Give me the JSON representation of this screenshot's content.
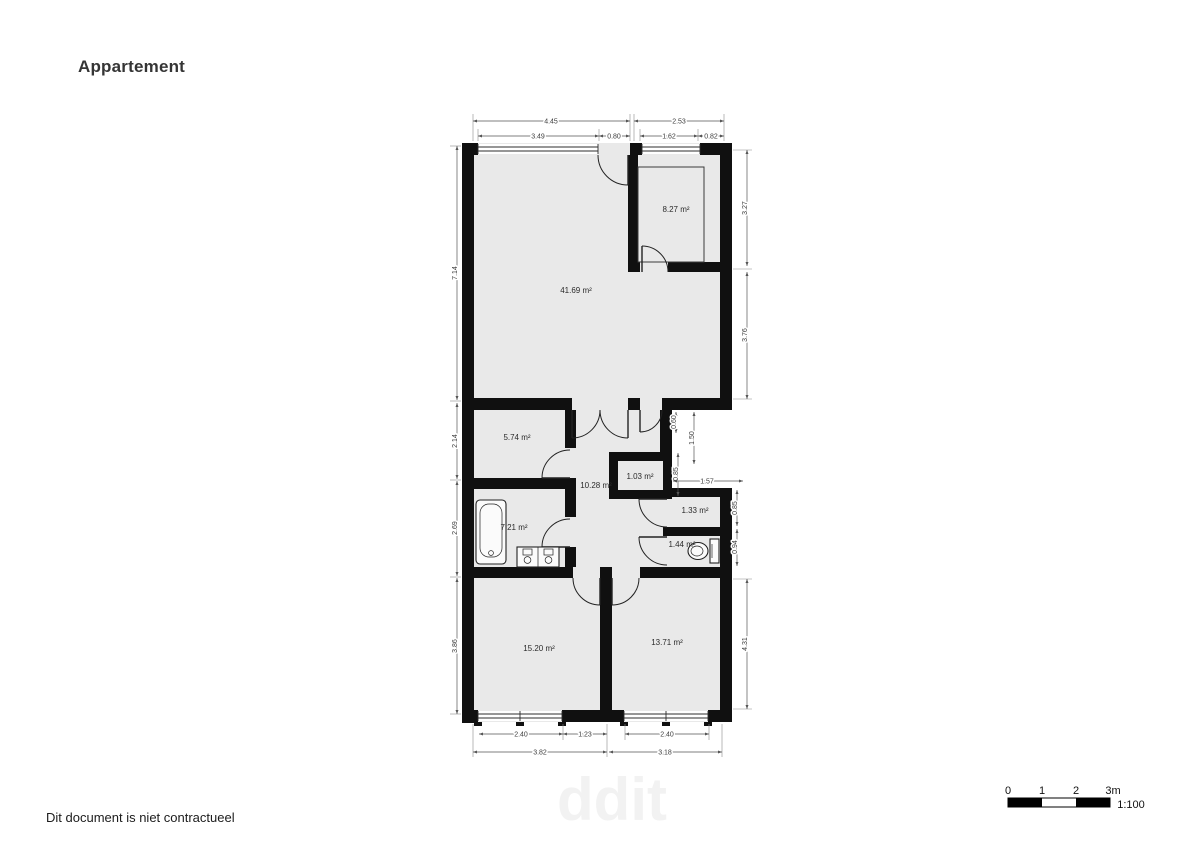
{
  "title": "Appartement",
  "disclaimer": "Dit document is niet contractueel",
  "watermark": "ddit",
  "scale_bar": {
    "ticks": [
      "0",
      "1",
      "2",
      "3m"
    ],
    "ratio": "1:100"
  },
  "rooms": {
    "living": "41.69 m²",
    "kitchen": "8.27 m²",
    "laundry": "5.74 m²",
    "hall": "10.28 m²",
    "closet": "1.03 m²",
    "bathroom": "7.21 m²",
    "storage": "1.33 m²",
    "wc": "1.44 m²",
    "bedroom_left": "15.20 m²",
    "bedroom_right": "13.71 m²"
  },
  "dims": {
    "top_row1": [
      "4.45",
      "2.53"
    ],
    "top_row2": [
      "3.49",
      "0.80",
      "1.62",
      "0.82"
    ],
    "left": [
      "7.14",
      "2.14",
      "2.69",
      "3.86"
    ],
    "right": [
      "3.27",
      "3.76",
      "0.60",
      "1.50",
      "0.85",
      "1.57",
      "0.85",
      "0.94",
      "4.31"
    ],
    "bottom_row1": [
      "2.40",
      "1.23",
      "2.40"
    ],
    "bottom_row2": [
      "3.82",
      "3.18"
    ]
  },
  "colors": {
    "wall": "#101010",
    "floor": "#e9e9e9",
    "dimension": "#555555",
    "background": "#ffffff"
  }
}
